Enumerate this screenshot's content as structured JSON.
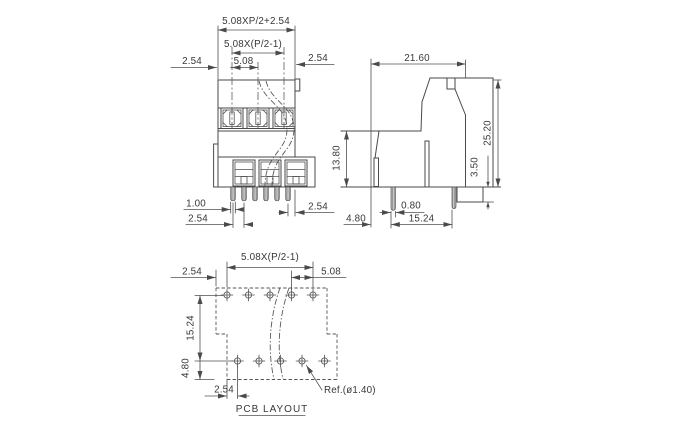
{
  "drawing": {
    "front_view": {
      "dim_overall": "5.08XP/2+2.54",
      "dim_span": "5.08X(P/2-1)",
      "dim_left_margin": "2.54",
      "dim_pitch": "5.08",
      "dim_right_margin": "2.54",
      "dim_pin_width": "1.00",
      "dim_pin_pitch": "2.54",
      "dim_right_offset": "2.54"
    },
    "side_view": {
      "dim_width": "21.60",
      "dim_height": "25.20",
      "dim_body_height": "13.80",
      "dim_peg_height": "3.50",
      "dim_pin_width": "0.80",
      "dim_pin_setback": "4.80",
      "dim_row_pitch": "15.24"
    },
    "pcb_layout": {
      "title": "PCB LAYOUT",
      "dim_span": "5.08X(P/2-1)",
      "dim_left_offset": "2.54",
      "dim_pitch": "5.08",
      "dim_row_pitch": "15.24",
      "dim_edge_offset": "4.80",
      "dim_stagger": "2.54",
      "hole_ref": "Ref.(ø1.40)"
    }
  }
}
